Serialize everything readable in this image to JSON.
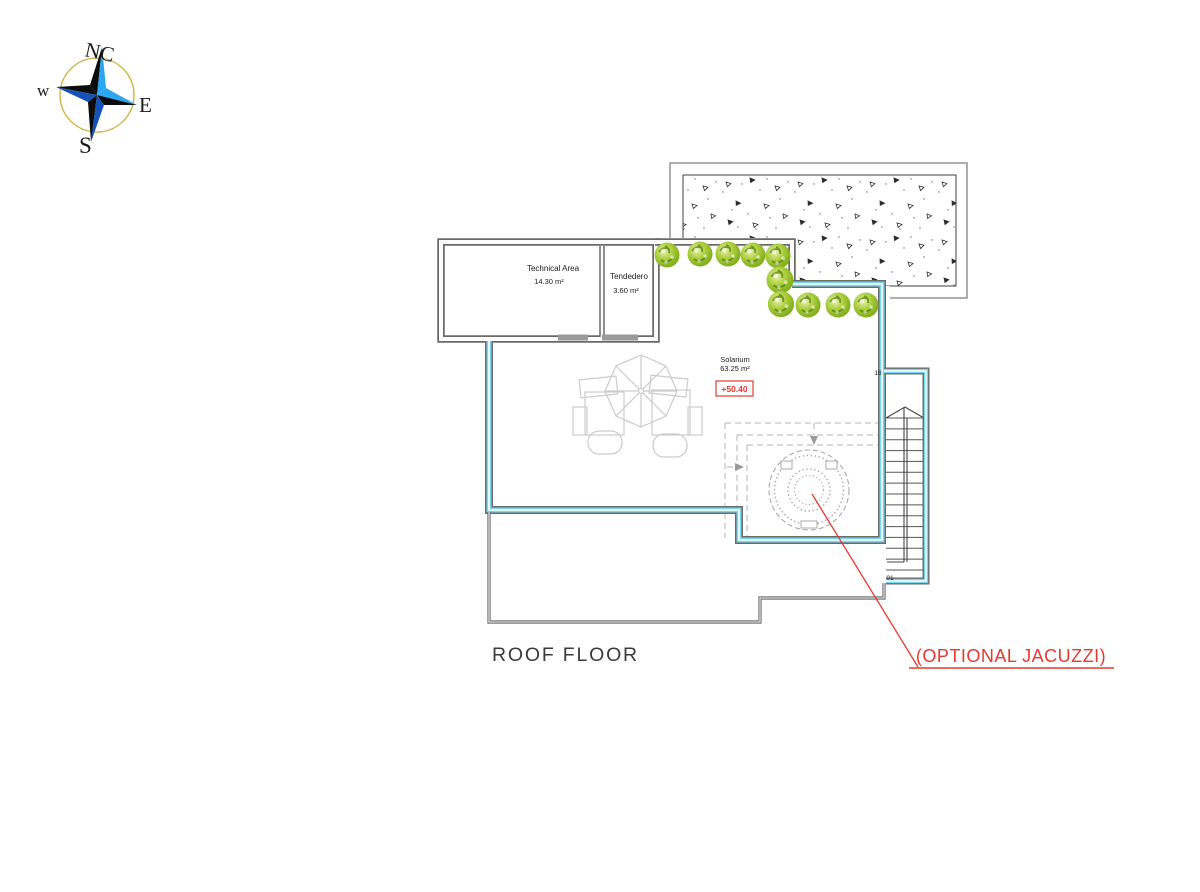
{
  "title": {
    "text": "ROOF FLOOR"
  },
  "compass": {
    "north_label": "NC",
    "west_label": "w",
    "east_label": "E",
    "south_label": "S"
  },
  "rooms": {
    "technical_area": {
      "name": "Technical Area",
      "area": "14.30 m²"
    },
    "tendedero": {
      "name": "Tendedero",
      "area": "3.60 m²"
    },
    "solarium": {
      "name": "Solarium",
      "area": "63.25 m²",
      "level_marker": "+50.40"
    }
  },
  "stairs": {
    "top_step_label": "18",
    "bottom_step_label": "01"
  },
  "annotations": {
    "jacuzzi": {
      "label": "(OPTIONAL JACUZZI)"
    }
  },
  "colors": {
    "annotation_red": "#e8382f",
    "parapet_highlight_cyan": "#79d6f0",
    "wall_gray": "#6a6a6a",
    "bush_green": "#8ab81e",
    "furniture_gray": "#cbcbcb",
    "compass_gold": "#c9b23c",
    "compass_blue_bright": "#2aa7f0",
    "compass_blue_dark": "#1452b8"
  }
}
